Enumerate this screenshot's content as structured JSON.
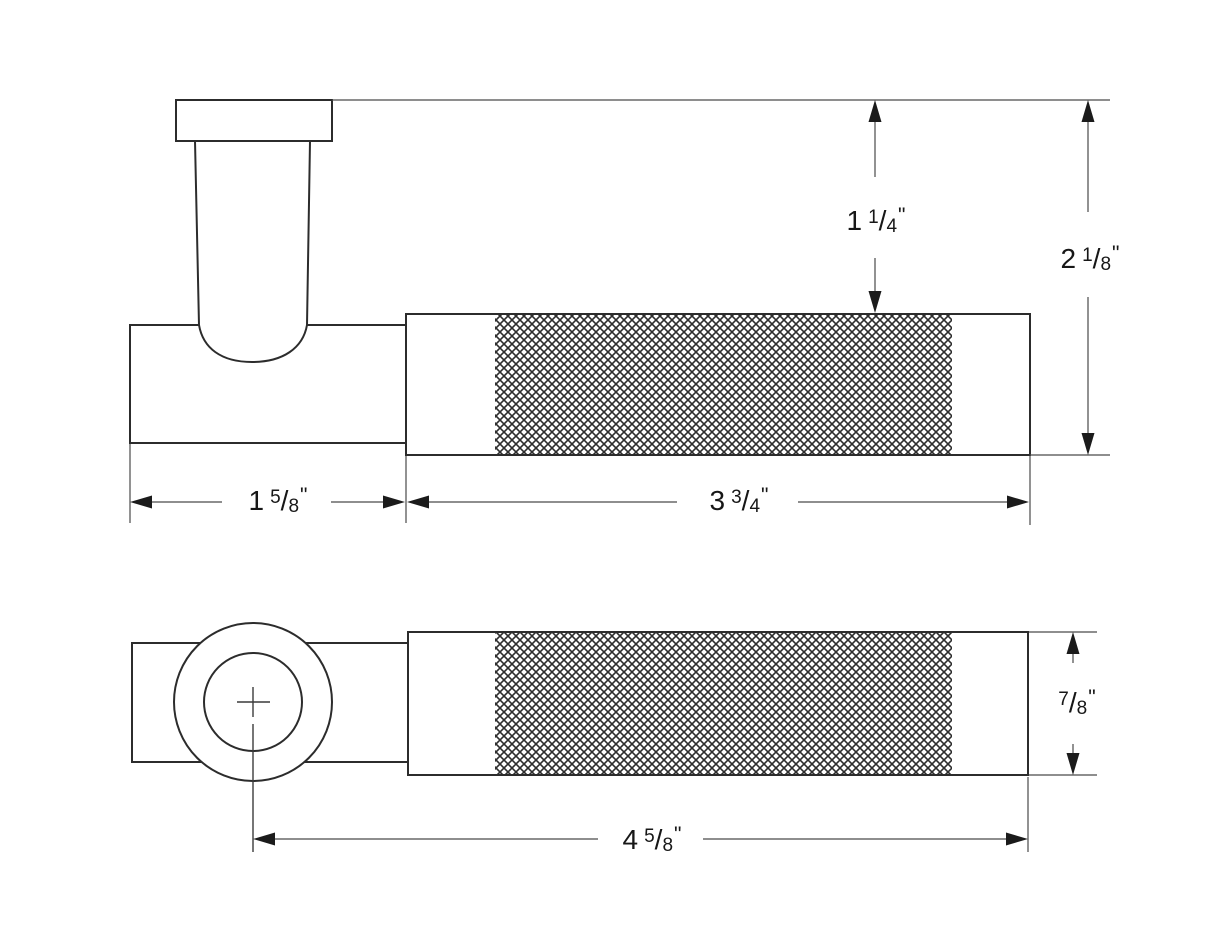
{
  "drawing": {
    "description": "two-view technical dimension drawing of a knurled lever handle",
    "colors": {
      "background": "#ffffff",
      "outline": "#2c2c2c",
      "dimension_line": "#4a4a4a",
      "arrowhead": "#1b1b1b",
      "text": "#171717",
      "knurl_hatch": "#2e2e2e"
    }
  },
  "dims": {
    "knurl_to_top": {
      "text": "1 1/4\"",
      "main": "1",
      "num": "1",
      "slash": "/",
      "den": "4",
      "unit": "\""
    },
    "overall_height": {
      "text": "2 1/8\"",
      "main": "2",
      "num": "1",
      "slash": "/",
      "den": "8",
      "unit": "\""
    },
    "hub_length": {
      "text": "1 5/8\"",
      "main": "1",
      "num": "5",
      "slash": "/",
      "den": "8",
      "unit": "\""
    },
    "grip_length": {
      "text": "3 3/4\"",
      "main": "3",
      "num": "3",
      "slash": "/",
      "den": "4",
      "unit": "\""
    },
    "lever_diameter": {
      "text": "7/8\"",
      "main": "",
      "num": "7",
      "slash": "/",
      "den": "8",
      "unit": "\""
    },
    "overall_length": {
      "text": "4 5/8\"",
      "main": "4",
      "num": "5",
      "slash": "/",
      "den": "8",
      "unit": "\""
    }
  }
}
